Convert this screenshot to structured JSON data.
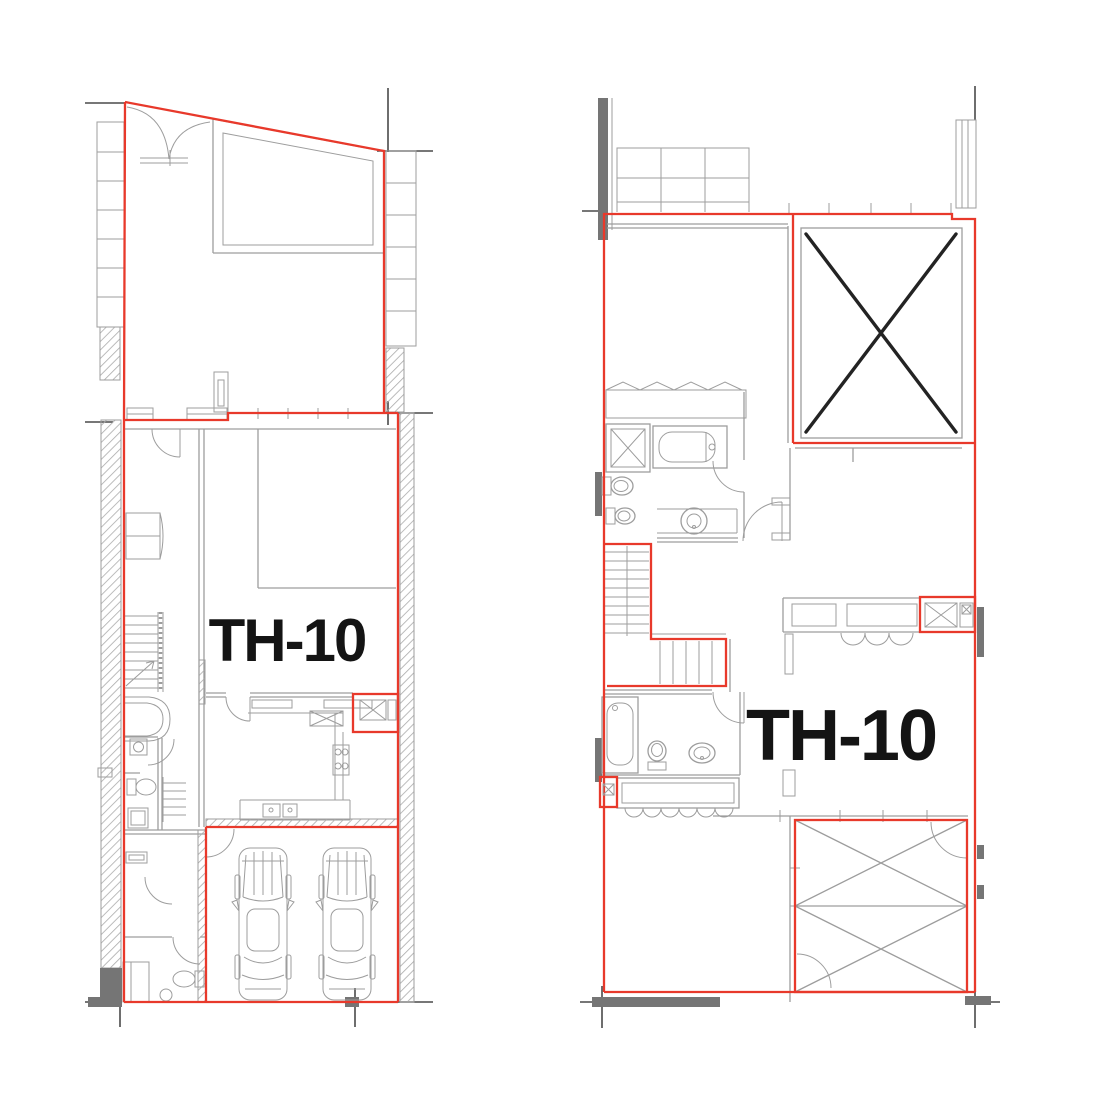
{
  "sheet": {
    "description": "Two townhouse floor plans with red unit-boundary outlines",
    "plans": {
      "left": {
        "name": "lower-floor-plan",
        "unit_label": "TH-10"
      },
      "right": {
        "name": "upper-floor-plan",
        "unit_label": "TH-10"
      }
    },
    "colors": {
      "red": "#e8392b",
      "gray": "#9d9d9d",
      "dark": "#4a4a4a",
      "wallfill": "#757575",
      "voidx": "#232323",
      "label": "#141414",
      "bg": "#ffffff"
    }
  }
}
